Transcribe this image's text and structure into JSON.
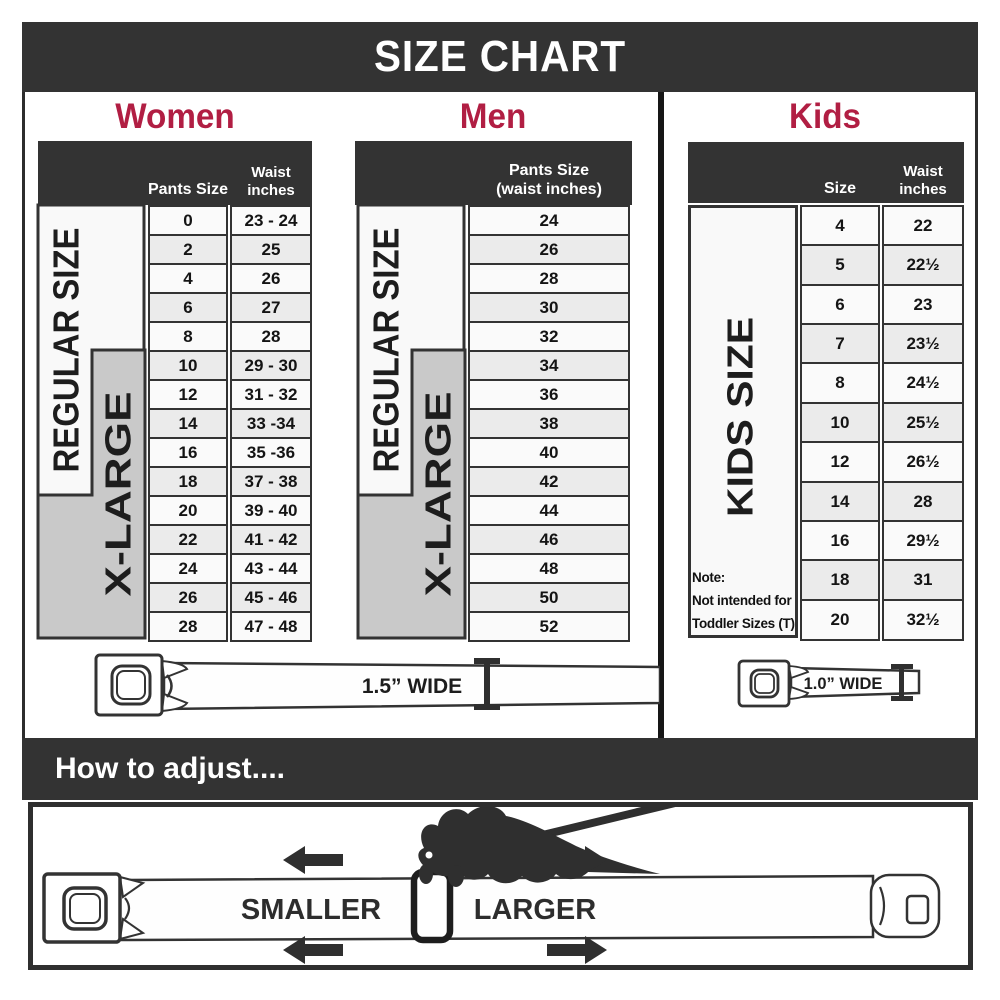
{
  "title": "SIZE CHART",
  "colors": {
    "accent_red": "#b11e43",
    "band_dark": "#333333",
    "xlarge_gray": "#c9c9c9",
    "row_alt_gray": "#ebebeb"
  },
  "sections": {
    "women": {
      "label": "Women",
      "col1_header": "Pants Size",
      "col2_header_line1": "Waist",
      "col2_header_line2": "inches",
      "regular_label": "REGULAR SIZE",
      "xlarge_label": "X-LARGE",
      "rows": [
        {
          "size": "0",
          "waist": "23 - 24"
        },
        {
          "size": "2",
          "waist": "25"
        },
        {
          "size": "4",
          "waist": "26"
        },
        {
          "size": "6",
          "waist": "27"
        },
        {
          "size": "8",
          "waist": "28"
        },
        {
          "size": "10",
          "waist": "29 - 30"
        },
        {
          "size": "12",
          "waist": "31 - 32"
        },
        {
          "size": "14",
          "waist": "33 -34"
        },
        {
          "size": "16",
          "waist": "35 -36"
        },
        {
          "size": "18",
          "waist": "37 - 38"
        },
        {
          "size": "20",
          "waist": "39 - 40"
        },
        {
          "size": "22",
          "waist": "41 - 42"
        },
        {
          "size": "24",
          "waist": "43 - 44"
        },
        {
          "size": "26",
          "waist": "45 - 46"
        },
        {
          "size": "28",
          "waist": "47 - 48"
        }
      ]
    },
    "men": {
      "label": "Men",
      "col_header_line1": "Pants Size",
      "col_header_line2": "(waist inches)",
      "regular_label": "REGULAR SIZE",
      "xlarge_label": "X-LARGE",
      "rows": [
        "24",
        "26",
        "28",
        "30",
        "32",
        "34",
        "36",
        "38",
        "40",
        "42",
        "44",
        "46",
        "48",
        "50",
        "52"
      ]
    },
    "kids": {
      "label": "Kids",
      "col1_header": "Size",
      "col2_header_line1": "Waist",
      "col2_header_line2": "inches",
      "side_label": "KIDS SIZE",
      "note_line1": "Note:",
      "note_line2": "Not intended for",
      "note_line3": "Toddler Sizes (T)",
      "rows": [
        {
          "size": "4",
          "waist": "22"
        },
        {
          "size": "5",
          "waist": "22½"
        },
        {
          "size": "6",
          "waist": "23"
        },
        {
          "size": "7",
          "waist": "23½"
        },
        {
          "size": "8",
          "waist": "24½"
        },
        {
          "size": "10",
          "waist": "25½"
        },
        {
          "size": "12",
          "waist": "26½"
        },
        {
          "size": "14",
          "waist": "28"
        },
        {
          "size": "16",
          "waist": "29½"
        },
        {
          "size": "18",
          "waist": "31"
        },
        {
          "size": "20",
          "waist": "32½"
        }
      ]
    }
  },
  "belts": {
    "adult_label": "1.5” WIDE",
    "kids_label": "1.0” WIDE"
  },
  "adjust": {
    "title": "How to adjust....",
    "smaller_label": "SMALLER",
    "larger_label": "LARGER"
  },
  "chart_data": [
    {
      "type": "table",
      "title": "Women",
      "columns": [
        "Pants Size",
        "Waist inches"
      ],
      "rows": [
        [
          "0",
          "23 - 24"
        ],
        [
          "2",
          "25"
        ],
        [
          "4",
          "26"
        ],
        [
          "6",
          "27"
        ],
        [
          "8",
          "28"
        ],
        [
          "10",
          "29 - 30"
        ],
        [
          "12",
          "31 - 32"
        ],
        [
          "14",
          "33 -34"
        ],
        [
          "16",
          "35 -36"
        ],
        [
          "18",
          "37 - 38"
        ],
        [
          "20",
          "39 - 40"
        ],
        [
          "22",
          "41 - 42"
        ],
        [
          "24",
          "43 - 44"
        ],
        [
          "26",
          "45 - 46"
        ],
        [
          "28",
          "47 - 48"
        ]
      ],
      "groups": {
        "REGULAR SIZE": [
          "0",
          "2",
          "4",
          "6",
          "8",
          "10",
          "12",
          "14",
          "16",
          "18"
        ],
        "X-LARGE": [
          "10",
          "12",
          "14",
          "16",
          "18",
          "20",
          "22",
          "24",
          "26",
          "28"
        ]
      },
      "belt_width": "1.5” WIDE"
    },
    {
      "type": "table",
      "title": "Men",
      "columns": [
        "Pants Size (waist inches)"
      ],
      "rows": [
        [
          "24"
        ],
        [
          "26"
        ],
        [
          "28"
        ],
        [
          "30"
        ],
        [
          "32"
        ],
        [
          "34"
        ],
        [
          "36"
        ],
        [
          "38"
        ],
        [
          "40"
        ],
        [
          "42"
        ],
        [
          "44"
        ],
        [
          "46"
        ],
        [
          "48"
        ],
        [
          "50"
        ],
        [
          "52"
        ]
      ],
      "groups": {
        "REGULAR SIZE": [
          "24",
          "26",
          "28",
          "30",
          "32",
          "34",
          "36",
          "38",
          "40",
          "42"
        ],
        "X-LARGE": [
          "34",
          "36",
          "38",
          "40",
          "42",
          "44",
          "46",
          "48",
          "50",
          "52"
        ]
      },
      "belt_width": "1.5” WIDE"
    },
    {
      "type": "table",
      "title": "Kids",
      "columns": [
        "Size",
        "Waist inches"
      ],
      "rows": [
        [
          "4",
          "22"
        ],
        [
          "5",
          "22½"
        ],
        [
          "6",
          "23"
        ],
        [
          "7",
          "23½"
        ],
        [
          "8",
          "24½"
        ],
        [
          "10",
          "25½"
        ],
        [
          "12",
          "26½"
        ],
        [
          "14",
          "28"
        ],
        [
          "16",
          "29½"
        ],
        [
          "18",
          "31"
        ],
        [
          "20",
          "32½"
        ]
      ],
      "groups": {
        "KIDS SIZE": [
          "4",
          "5",
          "6",
          "7",
          "8",
          "10",
          "12",
          "14",
          "16",
          "18",
          "20"
        ]
      },
      "note": "Not intended for Toddler Sizes (T)",
      "belt_width": "1.0” WIDE"
    }
  ]
}
